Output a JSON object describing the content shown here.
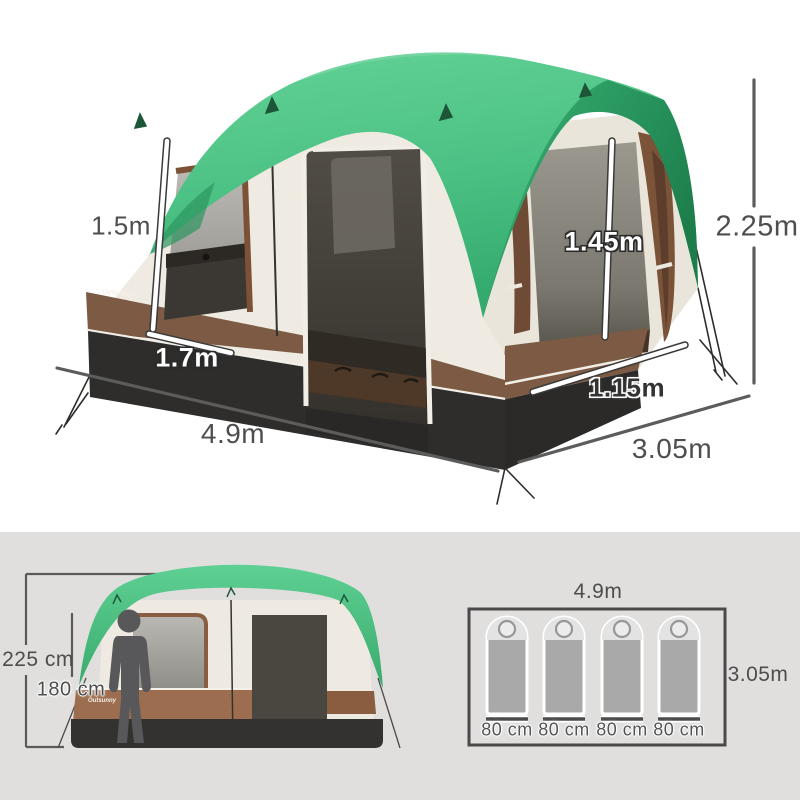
{
  "product_diagram": {
    "brand": "Outsunny",
    "view_3d": {
      "left_door_height": "1.5m",
      "left_door_width": "1.7m",
      "porch_door_height": "1.45m",
      "porch_door_width": "1.15m",
      "overall_height": "2.25m",
      "overall_length": "4.9m",
      "overall_depth": "3.05m"
    },
    "front_view": {
      "peak_height": "225 cm",
      "person_height": "180 cm",
      "brand": "Outsunny"
    },
    "floor_plan": {
      "length": "4.9m",
      "depth": "3.05m",
      "sleeping_bag_count": 4,
      "sleeping_bag_widths": [
        "80 cm",
        "80 cm",
        "80 cm",
        "80 cm"
      ]
    },
    "colors": {
      "canopy_green": "#57ca8d",
      "canopy_green_dark": "#1f8050",
      "wall_cream": "#efebe2",
      "trim_brown": "#7d5a43",
      "mesh_dark": "#45423c",
      "mesh_light": "#a5a29d",
      "base_dark": "#2e2d2b",
      "panel_gray": "#e0dfde",
      "dimension_gray": "#5c5c5c"
    }
  }
}
